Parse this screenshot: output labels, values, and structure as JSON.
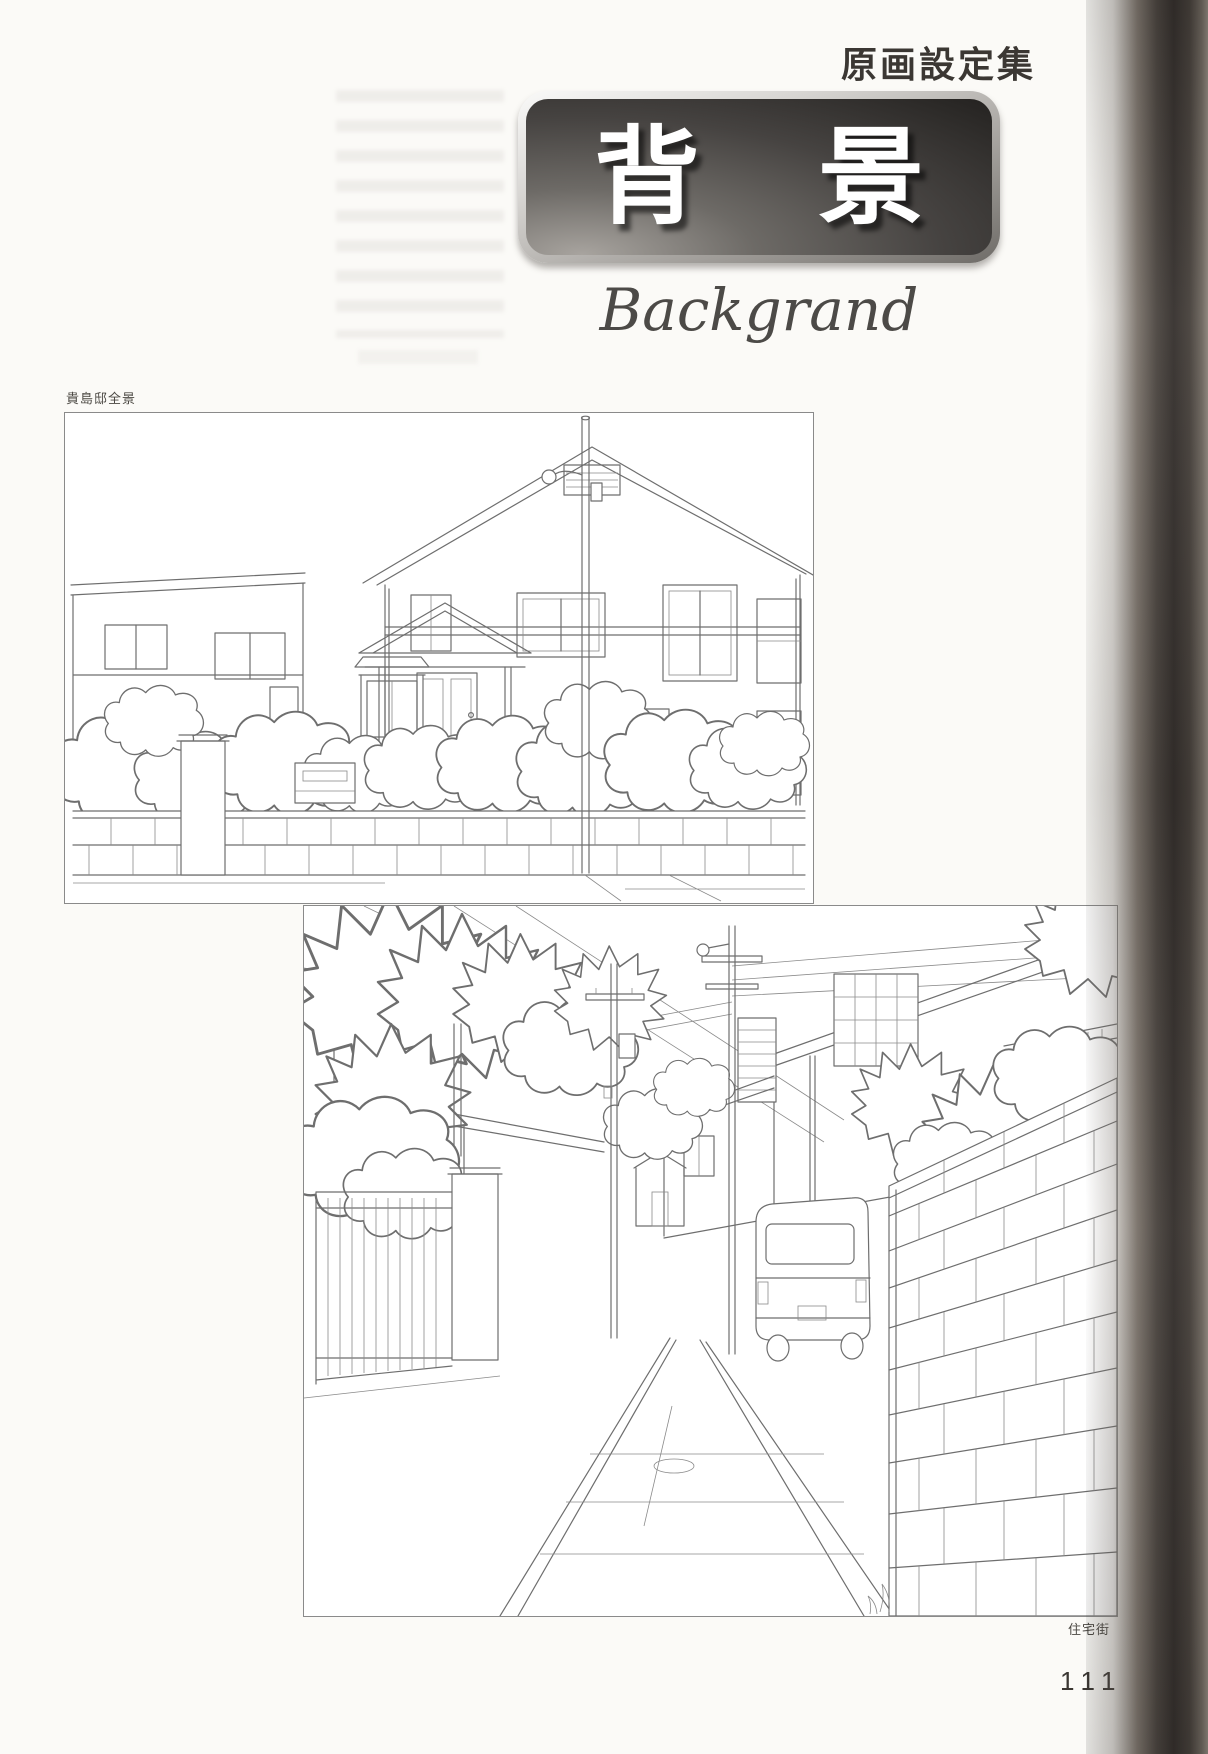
{
  "page": {
    "number": "111",
    "background": "#fbfaf7"
  },
  "header": {
    "label": "原画設定集"
  },
  "banner": {
    "title": "背景",
    "subtitle": "Backgrand"
  },
  "figures": [
    {
      "caption": "貴島邸全景"
    },
    {
      "caption": "住宅街"
    }
  ],
  "colors": {
    "line_art": "#6e6e6e",
    "banner_text": "#ffffff",
    "banner_dark": "#242220",
    "banner_bevel": "#d8d6d3",
    "binding_dark": "#342f2c",
    "text_dark": "#3b3733"
  }
}
